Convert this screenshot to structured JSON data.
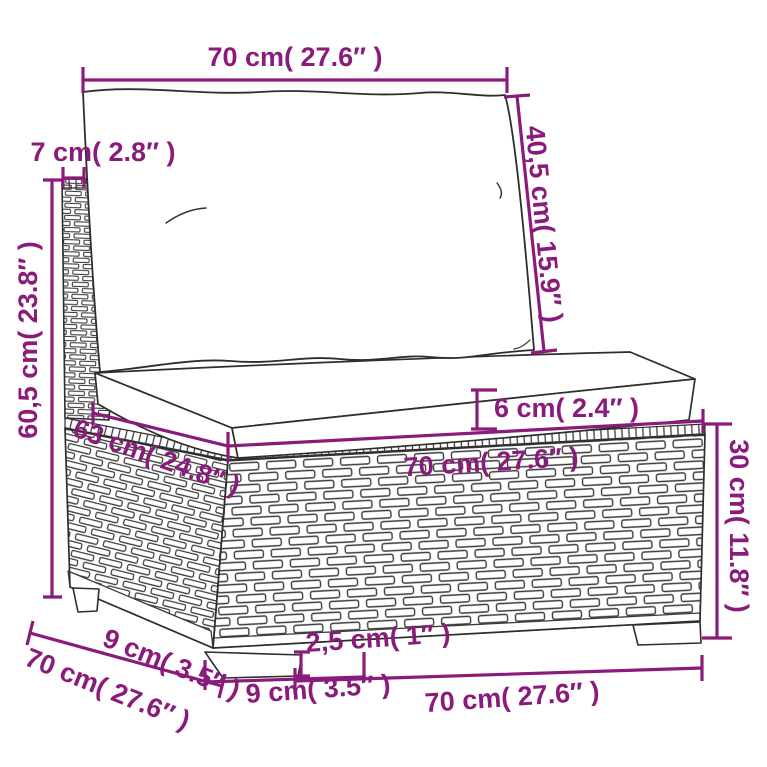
{
  "diagram": {
    "product": "poly-rattan-sofa-middle-section-with-cushions",
    "accent_color": "#8B1B7B",
    "line_color": "#2e2e2e",
    "dimensions": {
      "back_cushion_width": "70 cm( 27.6″ )",
      "back_panel_thickness": "7 cm( 2.8″ )",
      "back_cushion_height": "40,5 cm( 15.9″ )",
      "total_height": "60,5 cm( 23.8″ )",
      "seat_cushion_thickness": "6 cm( 2.4″ )",
      "seat_depth": "63 cm( 24.8″ )",
      "seat_width": "70 cm( 27.6″ )",
      "base_height": "30 cm( 11.8″ )",
      "side_foot_width": "9 cm( 3.5″ )",
      "side_depth": "70 cm( 27.6″ )",
      "front_foot_width": "9 cm( 3.5″ )",
      "foot_height": "2,5 cm( 1″ )",
      "front_width": "70 cm( 27.6″ )"
    }
  }
}
